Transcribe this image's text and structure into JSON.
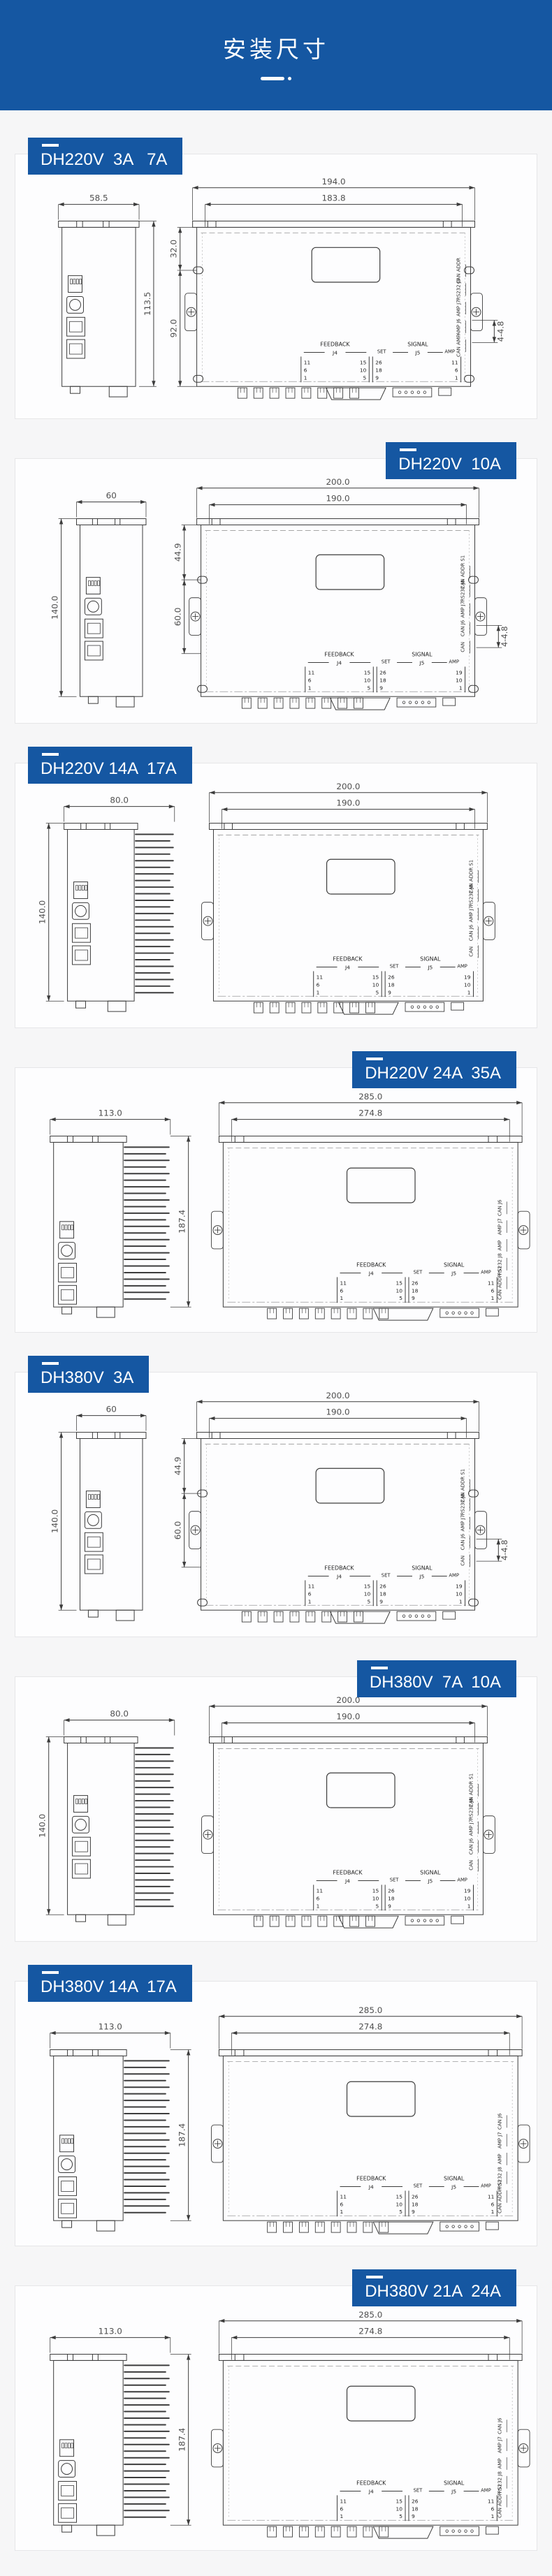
{
  "page": {
    "background": "#f6f6f7",
    "accent": "#1557a2"
  },
  "header": {
    "title": "安装尺寸"
  },
  "sections": [
    {
      "id": "dh220v-3a-7a",
      "label": "DH220V  3A   7A",
      "label_side": "left",
      "variant": "A",
      "side_view": {
        "width": "58.5",
        "height": "113.5"
      },
      "front_view": {
        "outer_width": "194.0",
        "inner_width": "183.8",
        "left_dims": [
          "32.0",
          "92.0"
        ],
        "hole_note": "4-4.8"
      },
      "right_stack": [
        "CAN ADDR",
        "RS232 J8",
        "AMP J7",
        "AMP J6",
        "CAN AMP"
      ],
      "pin_table": {
        "feedback": "FEEDBACK",
        "feedback_port": "J4",
        "set": "SET",
        "signal": "SIGNAL",
        "signal_port": "J5",
        "amp": "AMP",
        "feedback_left_pins": [
          "11",
          "6",
          "1"
        ],
        "feedback_right_pins": [
          "15",
          "10",
          "5"
        ],
        "set_pins": [
          "26",
          "18",
          "9"
        ],
        "signal_pins": [
          "11",
          "6",
          "1"
        ]
      }
    },
    {
      "id": "dh220v-10a",
      "label": "DH220V  10A",
      "label_side": "right",
      "variant": "B",
      "side_view": {
        "width": "60",
        "height": "140.0"
      },
      "front_view": {
        "outer_width": "200.0",
        "inner_width": "190.0",
        "left_dims": [
          "44.9",
          "60.0"
        ],
        "hole_note": "4-4.8"
      },
      "right_stack": [
        "CAN ADDR S1",
        "RS232 J8",
        "AMP J7",
        "CAN J6",
        "CAN"
      ],
      "pin_table": {
        "feedback": "FEEDBACK",
        "feedback_port": "J4",
        "set": "SET",
        "signal": "SIGNAL",
        "signal_port": "J5",
        "amp": "AMP",
        "feedback_left_pins": [
          "11",
          "6",
          "1"
        ],
        "feedback_right_pins": [
          "15",
          "10",
          "5"
        ],
        "set_pins": [
          "26",
          "18",
          "9"
        ],
        "signal_pins": [
          "19",
          "10",
          "1"
        ]
      }
    },
    {
      "id": "dh220v-14a-17a",
      "label": "DH220V 14A  17A",
      "label_side": "left",
      "variant": "C",
      "side_view": {
        "width": "80.0",
        "height": "140.0"
      },
      "front_view": {
        "outer_width": "200.0",
        "inner_width": "190.0",
        "left_dims": [],
        "hole_note": null
      },
      "right_stack": [
        "CAN ADDR S1",
        "RS232 J8",
        "AMP J7",
        "CAN J6",
        "CAN"
      ],
      "pin_table": {
        "feedback": "FEEDBACK",
        "feedback_port": "J4",
        "set": "SET",
        "signal": "SIGNAL",
        "signal_port": "J5",
        "amp": "AMP",
        "feedback_left_pins": [
          "11",
          "6",
          "1"
        ],
        "feedback_right_pins": [
          "15",
          "10",
          "5"
        ],
        "set_pins": [
          "26",
          "18",
          "9"
        ],
        "signal_pins": [
          "19",
          "10",
          "1"
        ]
      }
    },
    {
      "id": "dh220v-24a-35a",
      "label": "DH220V 24A  35A",
      "label_side": "right",
      "variant": "D",
      "side_view": {
        "width": "113.0",
        "height": "187.4"
      },
      "front_view": {
        "outer_width": "285.0",
        "inner_width": "274.8",
        "left_dims": [],
        "hole_note": null
      },
      "right_stack": [
        "CAN J6",
        "AMP J7",
        "AMP",
        "RS232 J8",
        "CAN ADDR S1"
      ],
      "pin_table": {
        "feedback": "FEEDBACK",
        "feedback_port": "J4",
        "set": "SET",
        "signal": "SIGNAL",
        "signal_port": "J5",
        "amp": "AMP",
        "feedback_left_pins": [
          "11",
          "6",
          "1"
        ],
        "feedback_right_pins": [
          "15",
          "10",
          "5"
        ],
        "set_pins": [
          "26",
          "18",
          "9"
        ],
        "signal_pins": [
          "11",
          "6",
          "1"
        ]
      }
    },
    {
      "id": "dh380v-3a",
      "label": "DH380V  3A",
      "label_side": "left",
      "variant": "B",
      "side_view": {
        "width": "60",
        "height": "140.0"
      },
      "front_view": {
        "outer_width": "200.0",
        "inner_width": "190.0",
        "left_dims": [
          "44.9",
          "60.0"
        ],
        "hole_note": "4-4.8"
      },
      "right_stack": [
        "CAN ADDR S1",
        "RS232 J8",
        "AMP J7",
        "CAN J6",
        "CAN"
      ],
      "pin_table": {
        "feedback": "FEEDBACK",
        "feedback_port": "J4",
        "set": "SET",
        "signal": "SIGNAL",
        "signal_port": "J5",
        "amp": "AMP",
        "feedback_left_pins": [
          "11",
          "6",
          "1"
        ],
        "feedback_right_pins": [
          "15",
          "10",
          "5"
        ],
        "set_pins": [
          "26",
          "18",
          "9"
        ],
        "signal_pins": [
          "19",
          "10",
          "1"
        ]
      }
    },
    {
      "id": "dh380v-7a-10a",
      "label": "DH380V  7A  10A",
      "label_side": "right",
      "variant": "C",
      "side_view": {
        "width": "80.0",
        "height": "140.0"
      },
      "front_view": {
        "outer_width": "200.0",
        "inner_width": "190.0",
        "left_dims": [],
        "hole_note": null
      },
      "right_stack": [
        "CAN ADDR S1",
        "RS232 J8",
        "AMP J7",
        "CAN J6",
        "CAN"
      ],
      "pin_table": {
        "feedback": "FEEDBACK",
        "feedback_port": "J4",
        "set": "SET",
        "signal": "SIGNAL",
        "signal_port": "J5",
        "amp": "AMP",
        "feedback_left_pins": [
          "11",
          "6",
          "1"
        ],
        "feedback_right_pins": [
          "15",
          "10",
          "5"
        ],
        "set_pins": [
          "26",
          "18",
          "9"
        ],
        "signal_pins": [
          "19",
          "10",
          "1"
        ]
      }
    },
    {
      "id": "dh380v-14a-17a",
      "label": "DH380V 14A  17A",
      "label_side": "left",
      "variant": "D",
      "side_view": {
        "width": "113.0",
        "height": "187.4"
      },
      "front_view": {
        "outer_width": "285.0",
        "inner_width": "274.8",
        "left_dims": [],
        "hole_note": null
      },
      "right_stack": [
        "CAN J6",
        "AMP J7",
        "AMP",
        "RS232 J8",
        "CAN ADDR S1"
      ],
      "pin_table": {
        "feedback": "FEEDBACK",
        "feedback_port": "J4",
        "set": "SET",
        "signal": "SIGNAL",
        "signal_port": "J5",
        "amp": "AMP",
        "feedback_left_pins": [
          "11",
          "6",
          "1"
        ],
        "feedback_right_pins": [
          "15",
          "10",
          "5"
        ],
        "set_pins": [
          "26",
          "18",
          "9"
        ],
        "signal_pins": [
          "11",
          "6",
          "1"
        ]
      }
    },
    {
      "id": "dh380v-21a-24a",
      "label": "DH380V 21A  24A",
      "label_side": "right",
      "variant": "D",
      "side_view": {
        "width": "113.0",
        "height": "187.4"
      },
      "front_view": {
        "outer_width": "285.0",
        "inner_width": "274.8",
        "left_dims": [],
        "hole_note": null
      },
      "right_stack": [
        "CAN J6",
        "AMP J7",
        "AMP",
        "RS232 J8",
        "CAN ADDR S1"
      ],
      "pin_table": {
        "feedback": "FEEDBACK",
        "feedback_port": "J4",
        "set": "SET",
        "signal": "SIGNAL",
        "signal_port": "J5",
        "amp": "AMP",
        "feedback_left_pins": [
          "11",
          "6",
          "1"
        ],
        "feedback_right_pins": [
          "15",
          "10",
          "5"
        ],
        "set_pins": [
          "26",
          "18",
          "9"
        ],
        "signal_pins": [
          "11",
          "6",
          "1"
        ]
      }
    }
  ]
}
